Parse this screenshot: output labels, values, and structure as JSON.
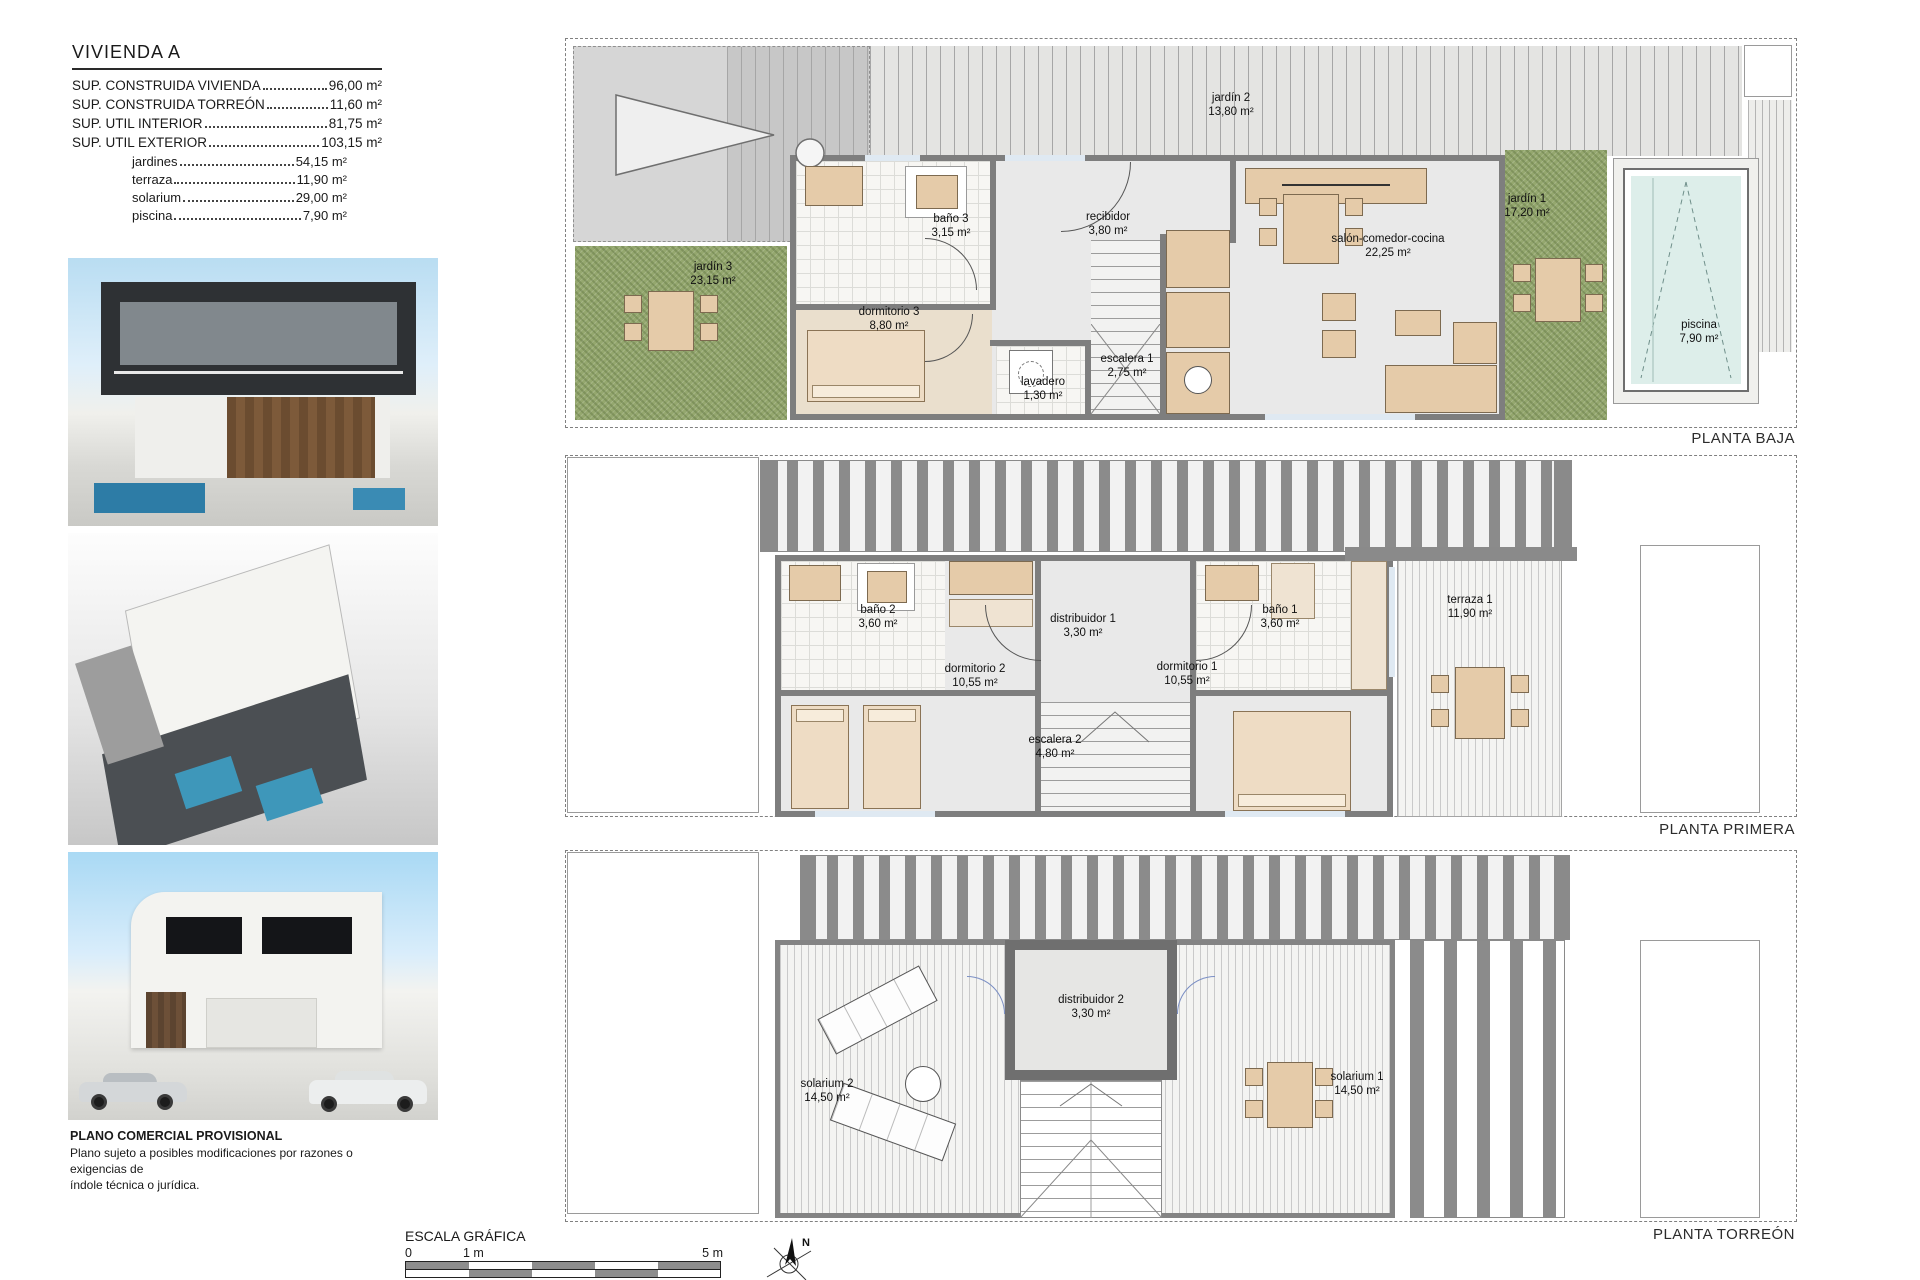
{
  "title_block": {
    "title": "VIVIENDA A",
    "specs": [
      {
        "label": "SUP. CONSTRUIDA VIVIENDA",
        "value": "96,00 m²"
      },
      {
        "label": "SUP. CONSTRUIDA TORREÓN",
        "value": "11,60 m²"
      },
      {
        "label": "SUP. UTIL INTERIOR",
        "value": "81,75 m²"
      },
      {
        "label": "SUP. UTIL EXTERIOR",
        "value": "103,15 m²"
      }
    ],
    "sub_specs": [
      {
        "label": "jardines",
        "value": "54,15 m²"
      },
      {
        "label": "terraza",
        "value": "11,90 m²"
      },
      {
        "label": "solarium",
        "value": "29,00 m²"
      },
      {
        "label": "piscina",
        "value": "7,90 m²"
      }
    ]
  },
  "disclaimer": {
    "title": "PLANO COMERCIAL PROVISIONAL",
    "line1": "Plano sujeto a posibles modificaciones por razones o exigencias de",
    "line2": "índole técnica o jurídica."
  },
  "scale_bar": {
    "title": "ESCALA GRÁFICA",
    "tick0": "0",
    "tick1": "1 m",
    "tick5": "5 m"
  },
  "north_label": "N",
  "plans": [
    {
      "label": "PLANTA BAJA",
      "rooms": [
        {
          "name": "jardín 2",
          "area": "13,80 m²"
        },
        {
          "name": "jardín 3",
          "area": "23,15 m²"
        },
        {
          "name": "baño 3",
          "area": "3,15 m²"
        },
        {
          "name": "recibidor",
          "area": "3,80 m²"
        },
        {
          "name": "dormitorio 3",
          "area": "8,80 m²"
        },
        {
          "name": "lavadero",
          "area": "1,30 m²"
        },
        {
          "name": "escalera 1",
          "area": "2,75 m²"
        },
        {
          "name": "salón-comedor-cocina",
          "area": "22,25 m²"
        },
        {
          "name": "jardín 1",
          "area": "17,20 m²"
        },
        {
          "name": "piscina",
          "area": "7,90 m²"
        }
      ]
    },
    {
      "label": "PLANTA PRIMERA",
      "rooms": [
        {
          "name": "baño 2",
          "area": "3,60 m²"
        },
        {
          "name": "distribuidor 1",
          "area": "3,30 m²"
        },
        {
          "name": "baño 1",
          "area": "3,60 m²"
        },
        {
          "name": "dormitorio 2",
          "area": "10,55 m²"
        },
        {
          "name": "dormitorio 1",
          "area": "10,55 m²"
        },
        {
          "name": "escalera 2",
          "area": "4,80 m²"
        },
        {
          "name": "terraza 1",
          "area": "11,90 m²"
        }
      ]
    },
    {
      "label": "PLANTA TORREÓN",
      "rooms": [
        {
          "name": "solarium 2",
          "area": "14,50 m²"
        },
        {
          "name": "distribuidor 2",
          "area": "3,30 m²"
        },
        {
          "name": "solarium 1",
          "area": "14,50 m²"
        }
      ]
    }
  ],
  "colors": {
    "wall": "#7e7e7e",
    "floor": "#e9e9e9",
    "furniture": "#e5cba9",
    "garden": "#94a76e",
    "pool_water": "#ddeeea",
    "sky": "#a9d9f4"
  }
}
